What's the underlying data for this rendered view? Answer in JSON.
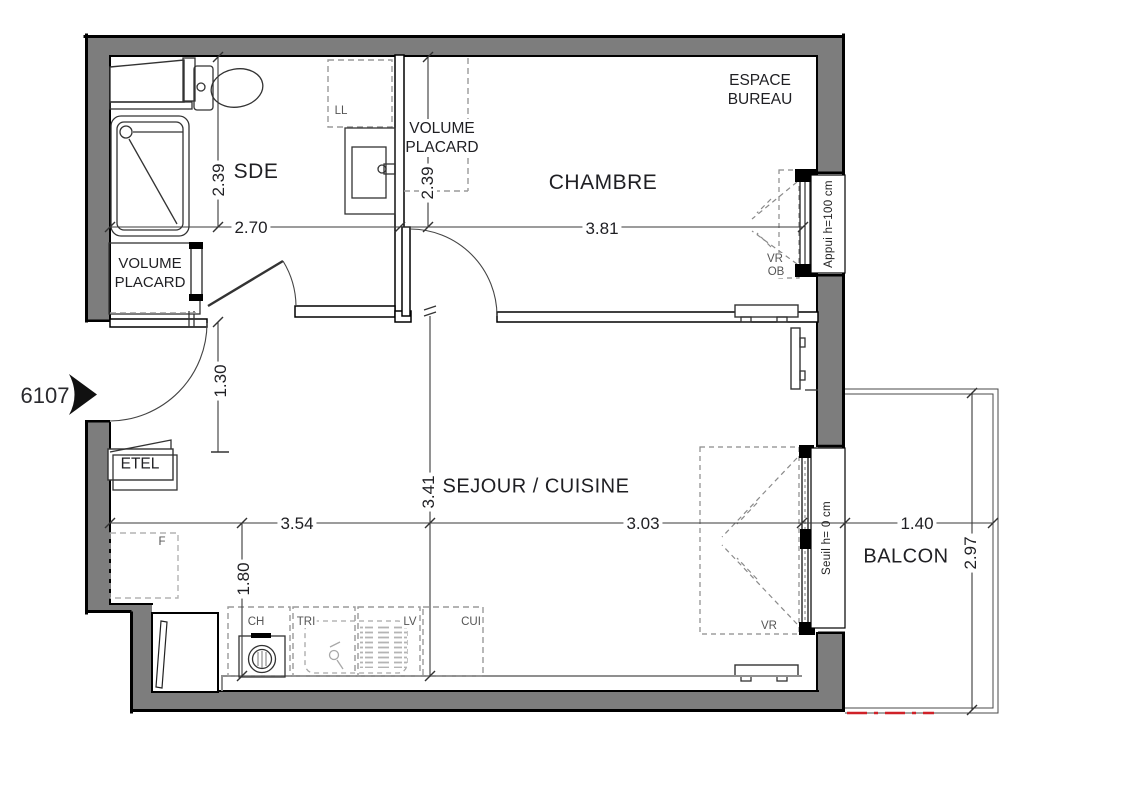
{
  "plan": {
    "unit_number": "6107",
    "rooms": {
      "sde": "SDE",
      "chambre": "CHAMBRE",
      "sejour_cuisine": "SEJOUR / CUISINE",
      "balcon": "BALCON",
      "espace_bureau_line1": "ESPACE",
      "espace_bureau_line2": "BUREAU",
      "volume_placard_line1": "VOLUME",
      "volume_placard_line2": "PLACARD",
      "etel": "ETEL"
    },
    "dimensions": {
      "sde_depth": "2.39",
      "sde_width": "2.70",
      "placard_depth": "2.39",
      "chambre_width": "3.81",
      "entry_width": "1.30",
      "sejour_depth": "3.41",
      "sejour_width_left": "3.54",
      "sejour_width_right": "3.03",
      "kitchen_depth": "1.80",
      "balcon_width": "1.40",
      "balcon_depth": "2.97"
    },
    "fixtures": {
      "ll": "LL",
      "ch": "CH",
      "tri": "TRI",
      "lv": "LV",
      "cui": "CUI",
      "f": "F",
      "vr": "VR",
      "ob": "OB"
    },
    "window_notes": {
      "chambre_window": "Appui h=100 cm",
      "balcony_door": "Seuil h= 0 cm"
    },
    "colors": {
      "wall_fill": "#7d7d7d",
      "red_dash": "#cf2128",
      "line": "#000000",
      "dash_gray": "#9a9a9a",
      "text": "#1f1f23"
    }
  }
}
